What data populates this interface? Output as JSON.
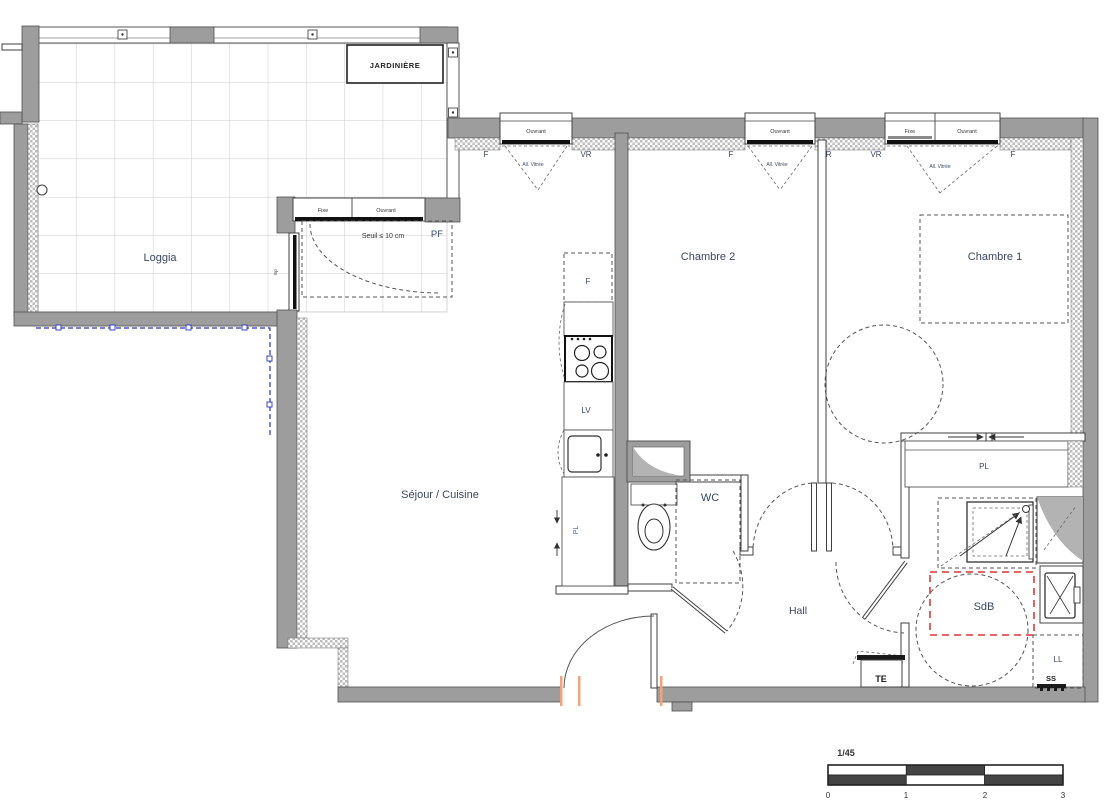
{
  "rooms": {
    "loggia": "Loggia",
    "sejour": "Séjour / Cuisine",
    "chambre2": "Chambre 2",
    "chambre1": "Chambre 1",
    "wc": "WC",
    "hall": "Hall",
    "sdb": "SdB"
  },
  "loggia": {
    "jardiniere": "JARDINIÈRE",
    "door_fixe": "Fixe",
    "door_ouvrant": "Ouvrant",
    "seuil": "Seuil ≤ 10 cm",
    "pf": "PF",
    "duct": "Ep"
  },
  "windows": {
    "sejour": {
      "sash": "Ouvrant",
      "left": "F",
      "right": "VR",
      "allege": "All. Vitrée"
    },
    "chambre2": {
      "sash": "Ouvrant",
      "left": "F",
      "right": "VR",
      "allege": "All. Vitrée"
    },
    "chambre1": {
      "fixe": "Fixe",
      "ouvrant": "Ouvrant",
      "left": "VR",
      "right": "F",
      "allege": "All. Vitrée"
    }
  },
  "fixtures": {
    "fridge": "F",
    "dishwasher": "LV",
    "kitchen_closet": "PL",
    "sdb_closet": "PL",
    "washing_machine": "LL",
    "floor_drain": "SS",
    "electrical_panel": "TE"
  },
  "scale": {
    "ratio": "1/45",
    "ticks": [
      "0",
      "1",
      "2",
      "3"
    ]
  },
  "colors": {
    "wall_gray": "#9d9d9d",
    "label_blue": "#3a4760",
    "accessibility_red": "#e05252",
    "railing_blue": "#2b35c0",
    "door_mark_orange": "#f2a37b"
  }
}
